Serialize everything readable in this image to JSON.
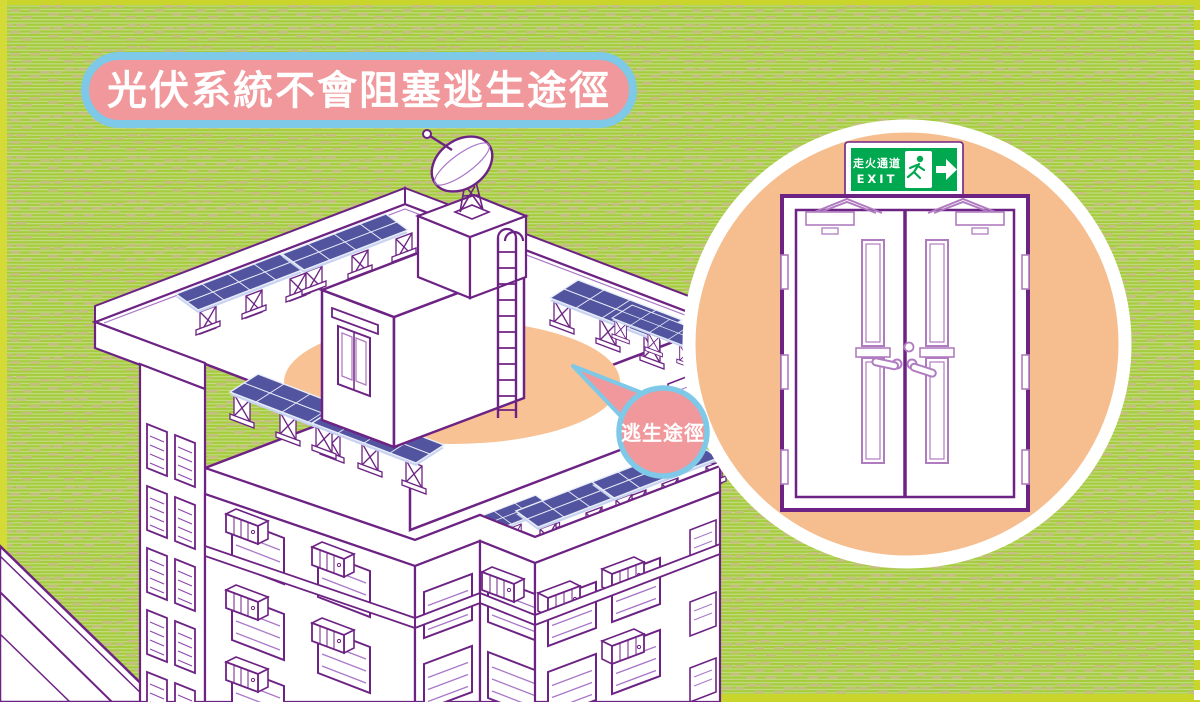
{
  "poster": {
    "title": "光伏系統不會阻塞逃生途徑",
    "speech_bubble_label": "逃生途徑",
    "exit_sign": {
      "chinese": "走火通道",
      "english": "EXIT"
    }
  },
  "colors": {
    "background_green": "#A6CC3E",
    "stripe_green": "#C5DC8B",
    "dash_tan": "#C8BC86",
    "border_strip_yellow": "#C9D52B",
    "banner_pink": "#F0989B",
    "banner_border_blue": "#7EC8E8",
    "outline_purple_dark": "#6D2383",
    "outline_purple_light": "#B07CC0",
    "roof_highlight_orange": "#F8C294",
    "inset_circle_orange": "#F6BD8E",
    "exit_sign_green": "#00A84F",
    "solar_panel_indigo": "#53549F",
    "white": "#FFFFFF"
  },
  "icons": [
    "satellite-dish-icon",
    "ladder-icon",
    "solar-panel-icon",
    "air-conditioner-icon",
    "running-man-icon",
    "arrow-right-icon",
    "speech-bubble-icon",
    "fire-door-icon"
  ]
}
